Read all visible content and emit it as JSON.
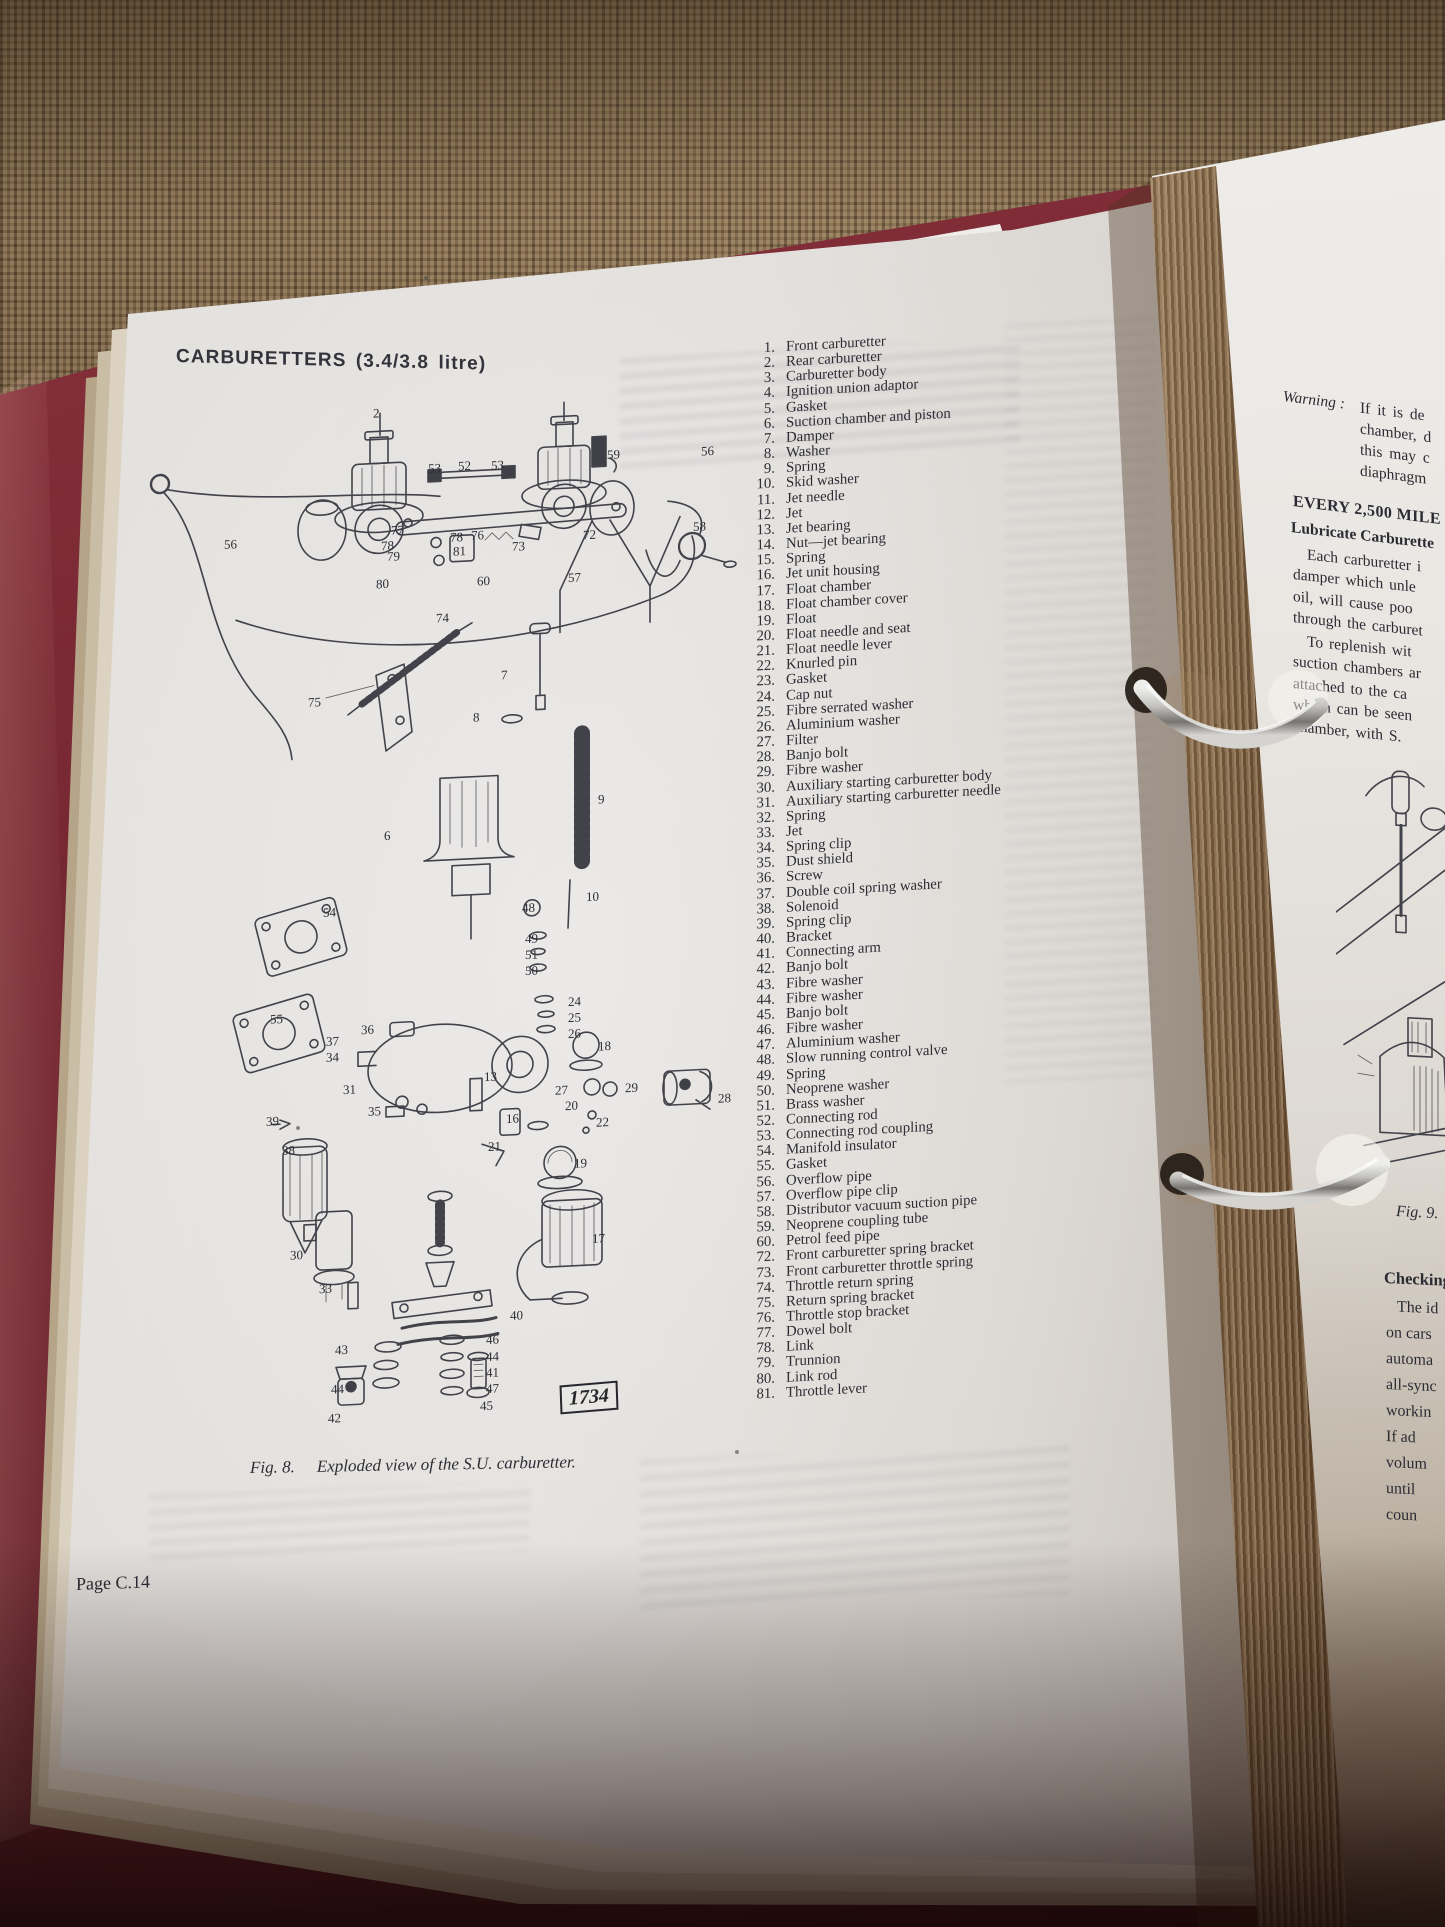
{
  "left_page": {
    "title": "CARBURETTERS (3.4/3.8 litre)",
    "page_number": "Page C.14",
    "figure8": {
      "caption_fig": "Fig. 8.",
      "caption_text": "Exploded view of the S.U. carburetter.",
      "plate_number": "1734",
      "callouts": [
        {
          "n": "2",
          "x": 233,
          "y": 2
        },
        {
          "n": "53",
          "x": 288,
          "y": 60
        },
        {
          "n": "52",
          "x": 318,
          "y": 59
        },
        {
          "n": "53",
          "x": 351,
          "y": 60
        },
        {
          "n": "59",
          "x": 467,
          "y": 55
        },
        {
          "n": "56",
          "x": 561,
          "y": 56
        },
        {
          "n": "56",
          "x": 84,
          "y": 126
        },
        {
          "n": "58",
          "x": 553,
          "y": 131
        },
        {
          "n": "77",
          "x": 251,
          "y": 120
        },
        {
          "n": "78",
          "x": 241,
          "y": 135
        },
        {
          "n": "78",
          "x": 310,
          "y": 130
        },
        {
          "n": "76",
          "x": 331,
          "y": 129
        },
        {
          "n": "79",
          "x": 247,
          "y": 146
        },
        {
          "n": "81",
          "x": 313,
          "y": 144
        },
        {
          "n": "73",
          "x": 372,
          "y": 142
        },
        {
          "n": "72",
          "x": 443,
          "y": 134
        },
        {
          "n": "80",
          "x": 236,
          "y": 173
        },
        {
          "n": "60",
          "x": 337,
          "y": 175
        },
        {
          "n": "57",
          "x": 428,
          "y": 176
        },
        {
          "n": "74",
          "x": 296,
          "y": 210
        },
        {
          "n": "75",
          "x": 168,
          "y": 288
        },
        {
          "n": "7",
          "x": 361,
          "y": 270
        },
        {
          "n": "8",
          "x": 333,
          "y": 311
        },
        {
          "n": "9",
          "x": 458,
          "y": 399
        },
        {
          "n": "6",
          "x": 244,
          "y": 425
        },
        {
          "n": "10",
          "x": 446,
          "y": 496
        },
        {
          "n": "48",
          "x": 382,
          "y": 504
        },
        {
          "n": "49",
          "x": 385,
          "y": 535
        },
        {
          "n": "51",
          "x": 385,
          "y": 551
        },
        {
          "n": "50",
          "x": 385,
          "y": 567
        },
        {
          "n": "54",
          "x": 183,
          "y": 499
        },
        {
          "n": "55",
          "x": 130,
          "y": 603
        },
        {
          "n": "24",
          "x": 428,
          "y": 600
        },
        {
          "n": "25",
          "x": 428,
          "y": 616
        },
        {
          "n": "26",
          "x": 428,
          "y": 632
        },
        {
          "n": "36",
          "x": 221,
          "y": 618
        },
        {
          "n": "37",
          "x": 186,
          "y": 628
        },
        {
          "n": "34",
          "x": 186,
          "y": 644
        },
        {
          "n": "18",
          "x": 458,
          "y": 646
        },
        {
          "n": "31",
          "x": 203,
          "y": 677
        },
        {
          "n": "13",
          "x": 344,
          "y": 671
        },
        {
          "n": "27",
          "x": 415,
          "y": 688
        },
        {
          "n": "29",
          "x": 485,
          "y": 689
        },
        {
          "n": "20",
          "x": 425,
          "y": 704
        },
        {
          "n": "28",
          "x": 578,
          "y": 704
        },
        {
          "n": "39",
          "x": 126,
          "y": 705
        },
        {
          "n": "35",
          "x": 228,
          "y": 700
        },
        {
          "n": "16",
          "x": 366,
          "y": 714
        },
        {
          "n": "22",
          "x": 456,
          "y": 722
        },
        {
          "n": "38",
          "x": 142,
          "y": 735
        },
        {
          "n": "21",
          "x": 348,
          "y": 741
        },
        {
          "n": "19",
          "x": 434,
          "y": 762
        },
        {
          "n": "30",
          "x": 150,
          "y": 840
        },
        {
          "n": "17",
          "x": 452,
          "y": 838
        },
        {
          "n": "33",
          "x": 179,
          "y": 875
        },
        {
          "n": "40",
          "x": 370,
          "y": 911
        },
        {
          "n": "43",
          "x": 195,
          "y": 937
        },
        {
          "n": "46",
          "x": 346,
          "y": 934
        },
        {
          "n": "44",
          "x": 346,
          "y": 951
        },
        {
          "n": "41",
          "x": 346,
          "y": 967
        },
        {
          "n": "47",
          "x": 346,
          "y": 983
        },
        {
          "n": "44",
          "x": 191,
          "y": 976
        },
        {
          "n": "45",
          "x": 340,
          "y": 1000
        },
        {
          "n": "42",
          "x": 188,
          "y": 1005
        }
      ]
    },
    "parts_list": [
      {
        "n": "1.",
        "t": "Front carburetter"
      },
      {
        "n": "2.",
        "t": "Rear carburetter"
      },
      {
        "n": "3.",
        "t": "Carburetter body"
      },
      {
        "n": "4.",
        "t": "Ignition union adaptor"
      },
      {
        "n": "5.",
        "t": "Gasket"
      },
      {
        "n": "6.",
        "t": "Suction chamber and piston"
      },
      {
        "n": "7.",
        "t": "Damper"
      },
      {
        "n": "8.",
        "t": "Washer"
      },
      {
        "n": "9.",
        "t": "Spring"
      },
      {
        "n": "10.",
        "t": "Skid washer"
      },
      {
        "n": "11.",
        "t": "Jet needle"
      },
      {
        "n": "12.",
        "t": "Jet"
      },
      {
        "n": "13.",
        "t": "Jet bearing"
      },
      {
        "n": "14.",
        "t": "Nut—jet bearing"
      },
      {
        "n": "15.",
        "t": "Spring"
      },
      {
        "n": "16.",
        "t": "Jet unit housing"
      },
      {
        "n": "17.",
        "t": "Float chamber"
      },
      {
        "n": "18.",
        "t": "Float chamber cover"
      },
      {
        "n": "19.",
        "t": "Float"
      },
      {
        "n": "20.",
        "t": "Float needle and seat"
      },
      {
        "n": "21.",
        "t": "Float needle lever"
      },
      {
        "n": "22.",
        "t": "Knurled pin"
      },
      {
        "n": "23.",
        "t": "Gasket"
      },
      {
        "n": "24.",
        "t": "Cap nut"
      },
      {
        "n": "25.",
        "t": "Fibre serrated washer"
      },
      {
        "n": "26.",
        "t": "Aluminium washer"
      },
      {
        "n": "27.",
        "t": "Filter"
      },
      {
        "n": "28.",
        "t": "Banjo bolt"
      },
      {
        "n": "29.",
        "t": "Fibre washer"
      },
      {
        "n": "30.",
        "t": "Auxiliary starting carburetter body"
      },
      {
        "n": "31.",
        "t": "Auxiliary starting carburetter needle"
      },
      {
        "n": "32.",
        "t": "Spring"
      },
      {
        "n": "33.",
        "t": "Jet"
      },
      {
        "n": "34.",
        "t": "Spring clip"
      },
      {
        "n": "35.",
        "t": "Dust shield"
      },
      {
        "n": "36.",
        "t": "Screw"
      },
      {
        "n": "37.",
        "t": "Double coil spring washer"
      },
      {
        "n": "38.",
        "t": "Solenoid"
      },
      {
        "n": "39.",
        "t": "Spring clip"
      },
      {
        "n": "40.",
        "t": "Bracket"
      },
      {
        "n": "41.",
        "t": "Connecting arm"
      },
      {
        "n": "42.",
        "t": "Banjo bolt"
      },
      {
        "n": "43.",
        "t": "Fibre washer"
      },
      {
        "n": "44.",
        "t": "Fibre washer"
      },
      {
        "n": "45.",
        "t": "Banjo bolt"
      },
      {
        "n": "46.",
        "t": "Fibre washer"
      },
      {
        "n": "47.",
        "t": "Aluminium washer"
      },
      {
        "n": "48.",
        "t": "Slow running control valve"
      },
      {
        "n": "49.",
        "t": "Spring"
      },
      {
        "n": "50.",
        "t": "Neoprene washer"
      },
      {
        "n": "51.",
        "t": "Brass washer"
      },
      {
        "n": "52.",
        "t": "Connecting rod"
      },
      {
        "n": "53.",
        "t": "Connecting rod coupling"
      },
      {
        "n": "54.",
        "t": "Manifold insulator"
      },
      {
        "n": "55.",
        "t": "Gasket"
      },
      {
        "n": "56.",
        "t": "Overflow pipe"
      },
      {
        "n": "57.",
        "t": "Overflow pipe clip"
      },
      {
        "n": "58.",
        "t": "Distributor vacuum suction pipe"
      },
      {
        "n": "59.",
        "t": "Neoprene coupling tube"
      },
      {
        "n": "60.",
        "t": "Petrol feed pipe"
      },
      {
        "n": "72.",
        "t": "Front carburetter spring bracket"
      },
      {
        "n": "73.",
        "t": "Front carburetter throttle spring"
      },
      {
        "n": "74.",
        "t": "Throttle return spring"
      },
      {
        "n": "75.",
        "t": "Return spring bracket"
      },
      {
        "n": "76.",
        "t": "Throttle stop bracket"
      },
      {
        "n": "77.",
        "t": "Dowel bolt"
      },
      {
        "n": "78.",
        "t": "Link"
      },
      {
        "n": "79.",
        "t": "Trunnion"
      },
      {
        "n": "80.",
        "t": "Link rod"
      },
      {
        "n": "81.",
        "t": "Throttle lever"
      }
    ]
  },
  "right_page": {
    "warning_label": "Warning :",
    "warning_lines": [
      "If it is de",
      "chamber, d",
      "this may c",
      "diaphragm"
    ],
    "interval_heading": "EVERY 2,500 MILE",
    "lubricate_heading": "Lubricate Carburette",
    "paragraph1": [
      "Each carburetter i",
      "damper which unle",
      "oil, will cause poo",
      "through the carburet"
    ],
    "paragraph2": [
      "To replenish wit",
      "suction chambers ar",
      "attached to the ca",
      "which can be seen",
      "chamber, with S."
    ],
    "fig9_caption": "Fig. 9.",
    "checking_heading": "Checking",
    "paragraph3": [
      "The id",
      "on cars",
      "automa",
      "all-sync",
      "workin",
      "If ad",
      "volum",
      "until",
      "coun"
    ]
  }
}
